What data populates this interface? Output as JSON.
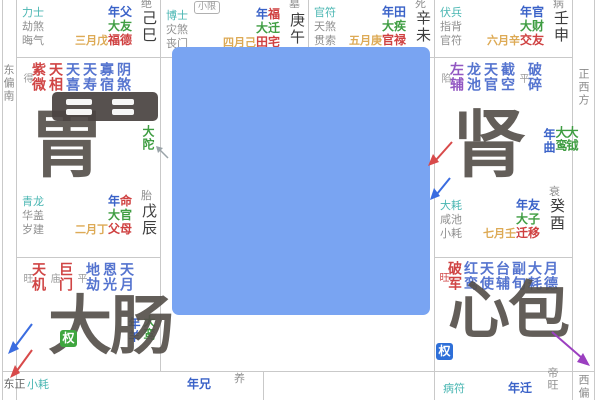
{
  "mask": {
    "color": "#79a4f2"
  },
  "badges": {
    "xiaoxian": "小限",
    "quan_green": "权",
    "quan_blue": "权"
  },
  "directions": {
    "left_top": "东偏南",
    "left_bottom": "正东",
    "right_top": "正西方",
    "right_bottom": "西偏"
  },
  "top_cells": [
    {
      "gods": [
        "力士",
        "劫煞",
        "晦气"
      ],
      "year": "年父",
      "decade": "大友",
      "month": "三月戊",
      "palace": "福德",
      "stem": "己巳",
      "stage": "绝"
    },
    {
      "gods": [
        "博士",
        "灾煞",
        "丧门"
      ],
      "year_pre": "年",
      "year_hl": "福",
      "decade": "大迁",
      "month": "四月己",
      "palace": "田宅",
      "stem": "庚午",
      "stage": "墓"
    },
    {
      "gods": [
        "官符",
        "天煞",
        "贯索"
      ],
      "year": "年田",
      "decade": "大疾",
      "month": "五月庚",
      "palace": "官禄",
      "stem": "辛未",
      "stage": "死"
    },
    {
      "gods": [
        "伏兵",
        "指背",
        "官符"
      ],
      "year": "年官",
      "decade": "大财",
      "month": "六月辛",
      "palace": "交友",
      "stem": "壬申",
      "stage": "病"
    }
  ],
  "mid_left": {
    "stars": [
      {
        "n": "紫微",
        "b": "得"
      },
      {
        "n": "天相"
      },
      {
        "n": "天喜"
      },
      {
        "n": "天寿"
      },
      {
        "n": "寡宿"
      },
      {
        "n": "阴煞"
      }
    ],
    "side": "大陀",
    "gods": [
      "青龙",
      "华盖",
      "岁建"
    ],
    "year_pre": "年",
    "year_hl": "命",
    "decade": "大官",
    "month": "二月丁",
    "palace": "父母",
    "stem": "戊辰",
    "stage": "胎",
    "watermark": "胃"
  },
  "mid_right": {
    "stars": [
      {
        "n": "左辅",
        "b": "陷"
      },
      {
        "n": "龙池"
      },
      {
        "n": "天官"
      },
      {
        "n": "截空"
      },
      {
        "n": "破碎",
        "b": "平"
      }
    ],
    "sides": [
      "年曲",
      "大鸾",
      "大钺"
    ],
    "gods": [
      "大耗",
      "咸池",
      "小耗"
    ],
    "year": "年友",
    "decade": "大子",
    "month": "七月壬",
    "palace": "迁移",
    "stem": "癸酉",
    "stage": "衰",
    "watermark": "肾"
  },
  "low_left": {
    "stars": [
      {
        "n": "天机",
        "b": "旺"
      },
      {
        "n": "巨门",
        "b": "庙"
      },
      {
        "n": "地劫",
        "b": "平"
      },
      {
        "n": "恩光"
      },
      {
        "n": "天月"
      }
    ],
    "sides": [
      "年羊",
      "大鸾"
    ],
    "watermark": "大肠"
  },
  "low_right": {
    "stars": [
      {
        "n": "破军",
        "b": "旺"
      },
      {
        "n": "红鸾"
      },
      {
        "n": "天使"
      },
      {
        "n": "台辅"
      },
      {
        "n": "副旬"
      },
      {
        "n": "大耗"
      },
      {
        "n": "月德"
      }
    ],
    "watermark": "心包"
  },
  "bottom_cells": {
    "left": {
      "god": "小耗",
      "year": "年兄",
      "stage": "养"
    },
    "right": {
      "god": "病符",
      "year": "年迁",
      "stage": "帝旺"
    }
  }
}
